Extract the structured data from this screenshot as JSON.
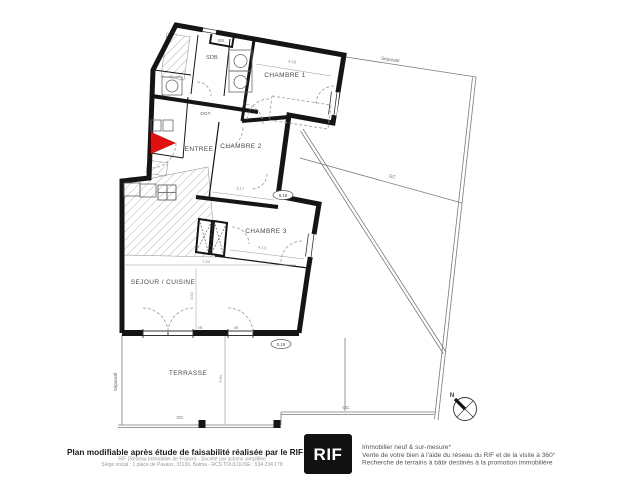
{
  "plan": {
    "rooms": [
      {
        "label": "SS"
      },
      {
        "label": "SDB"
      },
      {
        "label": "DGT."
      },
      {
        "label": "ENTREE"
      },
      {
        "label": "CHAMBRE 1"
      },
      {
        "label": "CHAMBRE 2"
      },
      {
        "label": "CHAMBRE 3"
      },
      {
        "label": "SEJOUR / CUISINE"
      },
      {
        "label": "TERRASSE"
      }
    ],
    "levels": [
      {
        "value": "8.19"
      },
      {
        "value": "0.19"
      }
    ],
    "dimensions": [
      {
        "value": "4.10"
      },
      {
        "value": "3.17"
      },
      {
        "value": "4.13"
      },
      {
        "value": "7.94"
      },
      {
        "value": "3.84"
      },
      {
        "value": "3.60"
      }
    ],
    "window_labels": [
      {
        "value": "VB"
      },
      {
        "value": "VB"
      }
    ],
    "boundaries": {
      "separatif": "Séparatif",
      "gc": "GC"
    },
    "compass": {
      "north": "N"
    },
    "colors": {
      "wall": "#151515",
      "entrance_marker": "#e01010",
      "thin_line": "#777777",
      "hatch": "#b0b0b0"
    }
  },
  "footer": {
    "main": "Plan modifiable après étude de faisabilité réalisée par le RIF",
    "legal_line1": "RIF (Réseau Immobilier de France) - Société par actions simplifiée",
    "legal_line2": "Siège social : 1 place de Pavaux, 31130, Balma - RCS TOULOUSE : 534 234 178",
    "logo": "RIF",
    "services": [
      {
        "text": "Immobilier neuf & sur-mesure*"
      },
      {
        "text": "Vente de votre bien à l'aide du réseau du RIF et de la visite à 360°"
      },
      {
        "text": "Recherche de terrains à bâtir destinés à la promotion immobilière"
      }
    ]
  }
}
